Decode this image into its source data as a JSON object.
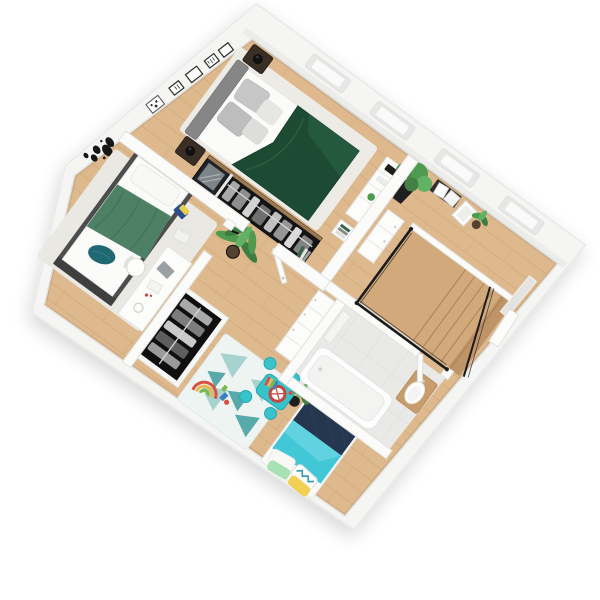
{
  "scene": {
    "type": "3d-floorplan-top-view-render",
    "view": "rotated isometric top-down apartment floor plan",
    "background": "#ffffff",
    "rotation_deg": 36.3
  },
  "rooms": [
    {
      "id": "master-bedroom",
      "floor": "wood with light rug",
      "items": [
        "double-bed-green-duvet",
        "gray-upholstered-headboard",
        "gray-pillows",
        "two-dark-nightstands",
        "black-sphere-lamps",
        "long-open-wardrobe-with-clothes",
        "mirror-cabinet",
        "white-dresser",
        "white-side-table-with-books",
        "four-black-wall-frames"
      ]
    },
    {
      "id": "landing",
      "floor": "wood",
      "items": [
        "staircase-opening",
        "black-framed-glass-railing",
        "tall-plant-black-vase",
        "ladder-shelf-with-frames",
        "leaning-picture-frames",
        "small-potted-plant",
        "white-drawer-unit",
        "leaning-mirror",
        "white-door"
      ]
    },
    {
      "id": "bathroom",
      "floor": "light gray tile",
      "items": [
        "bathtub",
        "toilet-on-wood-board",
        "white-radiator"
      ]
    },
    {
      "id": "small-bedroom",
      "floor": "wood with gray rug",
      "items": [
        "single-bed-dark-frame",
        "green-blanket",
        "teal-pillow",
        "white-desk",
        "white-chair",
        "notebooks-on-floor",
        "paper-stack",
        "world-map-wall-decal",
        "framed-art"
      ]
    },
    {
      "id": "kids-room",
      "floor": "wood",
      "items": [
        "open-black-wardrobe",
        "triangle-pattern-rug",
        "kids-bed-turquoise-duvet",
        "navy-blanket",
        "patterned-pillows",
        "teal-play-table",
        "four-teal-stools",
        "drum-toy",
        "xylophone-toy",
        "rainbow-stacker-toy",
        "potted-palm"
      ]
    },
    {
      "id": "hallway",
      "floor": "wood",
      "items": [
        "palm-plant-black-pot",
        "white-drawer-cabinet-row",
        "open-white-door",
        "book-stack",
        "black-wall-lamp"
      ]
    }
  ],
  "colors": {
    "wood_floor": "#deb98d",
    "wall": "#f5f5f4",
    "wall_stroke": "#e8e8e6",
    "roof_shade": "#ececea",
    "skylight": "#e7e7e5",
    "skylight_inner": "#fafafa",
    "interior_wall": "#fbfbfa",
    "interior_wall_stroke": "#e2e2e0",
    "master_rug": "#ecebe6",
    "duvet": "#1d4a33",
    "duvet_hi": "#265c40",
    "headboard": "#868686",
    "pillow_gray": "#c6c6c6",
    "pillow_light": "#e6e6e4",
    "nightstand": "#3a2f25",
    "lamp": "#111111",
    "wardrobe": "#141414",
    "wood_trim": "#9b7951",
    "clothes_a": "#a9a9a9",
    "clothes_b": "#6f6f6f",
    "rail": "#d7d7d7",
    "mirror": "#7e8589",
    "dresser": "#fcfcfb",
    "dresser_stroke": "#e4e4e2",
    "stair_wood": "#d2a97a",
    "step_line": "#b2875a",
    "railing": "#1b1b1b",
    "plant": "#4e9b50",
    "plant_dark": "#3e7d41",
    "plant_light": "#63b165",
    "pot": "#1f1f1f",
    "pot_brown": "#55412f",
    "bath_tile": "#e9e9e7",
    "tub": "#fdfdfd",
    "tub_inner": "#f3f3f1",
    "toilet_wood": "#c89d6c",
    "small_rug": "#e9e8e3",
    "bed_frame": "#4d4d4d",
    "mattress": "#fbfbfa",
    "blanket": "#4e8066",
    "teal_pillow": "#206872",
    "laptop": "#9aa0a4",
    "kids_rug": "#eef4f2",
    "tri_light": "#a6d3cf",
    "tri_dark": "#58a9a9",
    "kids_wardrobe": "#0f0f0f",
    "kids_teal": "#41c7d6",
    "kids_teal_hi": "#6fd9e4",
    "navy": "#24374e",
    "pillow_yellow": "#efd055",
    "pillow_green": "#a9e2b2",
    "zigzag": "#2f9aa8",
    "pillow_white": "#f8f8f7",
    "table": "#38c2ca",
    "table_stroke": "#27a7b0",
    "drum": "#c64540",
    "door": "#fcfcfb",
    "map_black": "#161616",
    "frame_black": "#2c2c2c",
    "notebook_blue": "#2a4d8f",
    "notebook_yellow": "#e5cf4b",
    "book_green": "#35654a",
    "toy_blue": "#3d7fc1",
    "toy_red": "#d94f43",
    "toy_yellow": "#e8b84b",
    "toy_green": "#7ab648"
  }
}
